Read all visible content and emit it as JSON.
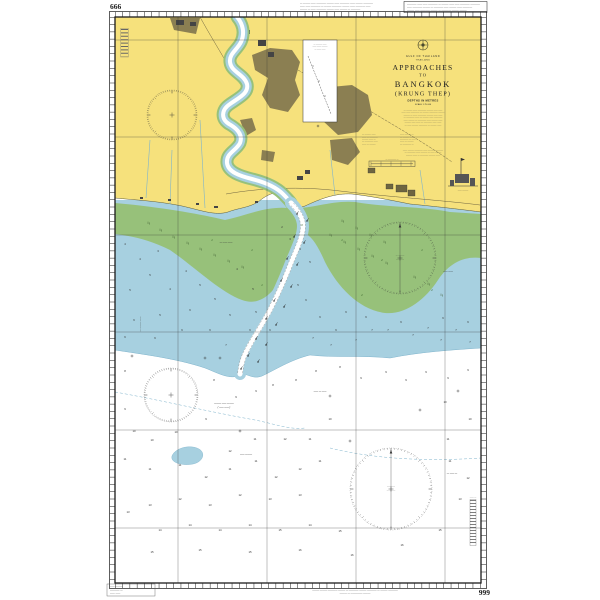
{
  "page": {
    "background": "#ffffff",
    "ink": "#1b1b1b"
  },
  "colors": {
    "land": "#f6e17c",
    "urban": "#8b7f52",
    "tidal_flats": "#97c17a",
    "shallow_water": "#a7d0e0",
    "deep_water": "#ffffff",
    "contour": "#7fb4cc"
  },
  "chart_numbers": {
    "top_left": "666",
    "bottom_right": "999"
  },
  "title_block": {
    "sea": "GULF OF THAILAND",
    "country": "THAILAND",
    "t1": "APPROACHES",
    "t2": "TO",
    "t3": "BANGKOK",
    "t4": "(KRUNG THEP)",
    "depths": "DEPTHS IN METRES",
    "scale": "SCALE 1:75 000",
    "para1": [
      "— ——— —— ———— ——— —— ——",
      "—— —— ———— — ——— ———— ———",
      "——— — —— ———— ——— —— ——",
      "— ———— —— — ——— —— ————",
      "—— ——— — ———— —— ——— ——",
      "——— —— —— — ———— —— ——",
      "— —— ——— ———— — ——— ——"
    ],
    "col_left": [
      "— ——— ——",
      "—— — ————",
      "——— —— —",
      "— ———— ——",
      "—— — ———"
    ],
    "col_right": [
      "—— ——— —",
      "— ——— ——",
      "———— — ——",
      "—— — ———",
      "— ———— —"
    ],
    "para2": [
      "—— ——— ———— —— ——— ————",
      "— ———— —— ——— — —— ———",
      "——— —— — ———— ——— ——"
    ],
    "scalebar_caption": "— ———— —"
  },
  "margin_notes": {
    "top_left_block": [
      "— ——— —— ———— ——— —— ———— —— ——— ————",
      "—— —— ———— — ——— ———— ——— —— ———— ——",
      "——— — —— ———— ——— —— ——— — ————"
    ],
    "top_right_box": [
      "———— —— —— ———— — ——— —— —— ———— ————",
      "—— ———— ——— — ———— —— ——— —— ————",
      "——— —— ———— ——— — ———— ——— ———"
    ],
    "bottom_left_block": [
      "—— ———",
      "———— —",
      "—— ——"
    ],
    "bottom_left_caption": "— ——— ———— —— ———— ——— —— ————",
    "bottom_center_line1": "——— ——— ———— ——— — ———— ——— ———— — ——— ————",
    "bottom_center_line2": "——— — ————— ———"
  },
  "inset": {
    "title_lines": [
      "— ——— ——",
      "—— —— ———",
      "— —— ——"
    ]
  },
  "facility": {
    "label": "—— ———"
  },
  "scale_ladder_caption": "—— —",
  "labels": [
    {
      "x": 226,
      "y": 243,
      "t": "— ―― ——"
    },
    {
      "x": 448,
      "y": 272,
      "t": "—— ——"
    },
    {
      "x": 224,
      "y": 404,
      "t": "——— —— ———"
    },
    {
      "x": 224,
      "y": 408,
      "t": "( —— —— )"
    },
    {
      "x": 246,
      "y": 455,
      "t": "—— ———"
    },
    {
      "x": 452,
      "y": 474,
      "t": "— —— —"
    },
    {
      "x": 320,
      "y": 392,
      "t": "—— — ——"
    }
  ],
  "rose_labels": {
    "r2_line1": "— ———",
    "r2_line2": "————",
    "r4_line1": "————",
    "r4_line2": "— ———"
  },
  "soundings": [
    [
      125,
      245,
      "4"
    ],
    [
      140,
      260,
      "4"
    ],
    [
      158,
      252,
      "3"
    ],
    [
      150,
      276,
      "5"
    ],
    [
      130,
      291,
      "5"
    ],
    [
      170,
      290,
      "4"
    ],
    [
      186,
      272,
      "4"
    ],
    [
      200,
      286,
      "5"
    ],
    [
      215,
      300,
      "5"
    ],
    [
      190,
      311,
      "6"
    ],
    [
      160,
      316,
      "5"
    ],
    [
      134,
      321,
      "6"
    ],
    [
      125,
      338,
      "6"
    ],
    [
      155,
      339,
      "6"
    ],
    [
      182,
      331,
      "6"
    ],
    [
      210,
      331,
      "6"
    ],
    [
      230,
      316,
      "5"
    ],
    [
      226,
      346,
      "7"
    ],
    [
      250,
      331,
      "6"
    ],
    [
      256,
      313,
      "5"
    ],
    [
      270,
      331,
      "6"
    ],
    [
      300,
      250,
      "4"
    ],
    [
      310,
      263,
      "5"
    ],
    [
      298,
      286,
      "5"
    ],
    [
      306,
      301,
      "6"
    ],
    [
      320,
      318,
      "6"
    ],
    [
      313,
      339,
      "7"
    ],
    [
      336,
      331,
      "6"
    ],
    [
      346,
      313,
      "6"
    ],
    [
      331,
      346,
      "7"
    ],
    [
      356,
      341,
      "7"
    ],
    [
      372,
      331,
      "7"
    ],
    [
      366,
      318,
      "6"
    ],
    [
      388,
      331,
      "7"
    ],
    [
      401,
      323,
      "6"
    ],
    [
      413,
      336,
      "7"
    ],
    [
      428,
      329,
      "7"
    ],
    [
      443,
      319,
      "6"
    ],
    [
      456,
      331,
      "7"
    ],
    [
      468,
      323,
      "6"
    ],
    [
      441,
      341,
      "7"
    ],
    [
      470,
      343,
      "7"
    ],
    [
      290,
      240,
      "3"
    ],
    [
      282,
      228,
      "2"
    ],
    [
      253,
      290,
      "5"
    ],
    [
      237,
      270,
      "4"
    ],
    [
      125,
      372,
      "8"
    ],
    [
      214,
      381,
      "8"
    ],
    [
      236,
      398,
      "9"
    ],
    [
      256,
      392,
      "9"
    ],
    [
      273,
      386,
      "8"
    ],
    [
      296,
      381,
      "8"
    ],
    [
      316,
      372,
      "8"
    ],
    [
      340,
      368,
      "8"
    ],
    [
      361,
      379,
      "9"
    ],
    [
      386,
      373,
      "9"
    ],
    [
      406,
      381,
      "9"
    ],
    [
      426,
      373,
      "9"
    ],
    [
      448,
      379,
      "9"
    ],
    [
      468,
      371,
      "9"
    ],
    [
      125,
      460,
      "11"
    ],
    [
      150,
      470,
      "11"
    ],
    [
      180,
      466,
      "11"
    ],
    [
      206,
      478,
      "12"
    ],
    [
      230,
      470,
      "11"
    ],
    [
      256,
      462,
      "11"
    ],
    [
      276,
      478,
      "12"
    ],
    [
      300,
      470,
      "12"
    ],
    [
      320,
      462,
      "11"
    ],
    [
      125,
      410,
      "9"
    ],
    [
      134,
      432,
      "10"
    ],
    [
      152,
      441,
      "10"
    ],
    [
      176,
      433,
      "10"
    ],
    [
      206,
      420,
      "9"
    ],
    [
      300,
      496,
      "13"
    ],
    [
      270,
      500,
      "13"
    ],
    [
      240,
      496,
      "12"
    ],
    [
      210,
      506,
      "13"
    ],
    [
      180,
      500,
      "12"
    ],
    [
      150,
      506,
      "13"
    ],
    [
      128,
      513,
      "13"
    ],
    [
      160,
      531,
      "14"
    ],
    [
      190,
      526,
      "14"
    ],
    [
      220,
      531,
      "14"
    ],
    [
      250,
      526,
      "14"
    ],
    [
      280,
      531,
      "15"
    ],
    [
      310,
      526,
      "14"
    ],
    [
      340,
      532,
      "15"
    ],
    [
      450,
      462,
      "11"
    ],
    [
      468,
      479,
      "12"
    ],
    [
      460,
      500,
      "13"
    ],
    [
      440,
      531,
      "15"
    ],
    [
      300,
      551,
      "16"
    ],
    [
      250,
      553,
      "15"
    ],
    [
      200,
      551,
      "15"
    ],
    [
      152,
      553,
      "15"
    ],
    [
      352,
      556,
      "16"
    ],
    [
      402,
      546,
      "16"
    ],
    [
      330,
      420,
      "10"
    ],
    [
      310,
      440,
      "11"
    ],
    [
      285,
      440,
      "12"
    ],
    [
      255,
      440,
      "11"
    ],
    [
      230,
      452,
      "12"
    ],
    [
      448,
      440,
      "11"
    ],
    [
      470,
      420,
      "10"
    ],
    [
      445,
      403,
      "10"
    ]
  ],
  "drying_heights": [
    [
      212,
      241,
      "1"
    ],
    [
      252,
      251,
      "1"
    ],
    [
      342,
      241,
      "1"
    ],
    [
      382,
      261,
      "2"
    ],
    [
      422,
      251,
      "1"
    ],
    [
      302,
      226,
      "0"
    ],
    [
      262,
      286,
      "1"
    ],
    [
      432,
      291,
      "2"
    ],
    [
      362,
      296,
      "2"
    ]
  ],
  "buoys": [
    [
      297,
      214
    ],
    [
      307,
      221
    ],
    [
      294,
      237
    ],
    [
      304,
      243
    ],
    [
      287,
      259
    ],
    [
      297,
      265
    ],
    [
      281,
      281
    ],
    [
      291,
      287
    ],
    [
      274,
      301
    ],
    [
      284,
      307
    ],
    [
      266,
      319
    ],
    [
      276,
      325
    ],
    [
      256,
      339
    ],
    [
      266,
      345
    ],
    [
      248,
      356
    ],
    [
      258,
      362
    ],
    [
      241,
      369
    ]
  ],
  "wrecks": [
    [
      220,
      358
    ],
    [
      330,
      396
    ],
    [
      420,
      410
    ],
    [
      132,
      356
    ],
    [
      458,
      391
    ],
    [
      350,
      441
    ],
    [
      240,
      431
    ],
    [
      205,
      358
    ]
  ],
  "stakes": [
    [
      148,
      224
    ],
    [
      160,
      231
    ],
    [
      173,
      238
    ],
    [
      187,
      244
    ],
    [
      200,
      250
    ],
    [
      214,
      256
    ],
    [
      228,
      262
    ],
    [
      242,
      268
    ],
    [
      330,
      236
    ],
    [
      344,
      243
    ],
    [
      358,
      250
    ],
    [
      372,
      257
    ],
    [
      386,
      264
    ],
    [
      414,
      278
    ],
    [
      428,
      285
    ],
    [
      342,
      222
    ],
    [
      356,
      229
    ],
    [
      370,
      236
    ],
    [
      384,
      243
    ],
    [
      441,
      296
    ]
  ]
}
